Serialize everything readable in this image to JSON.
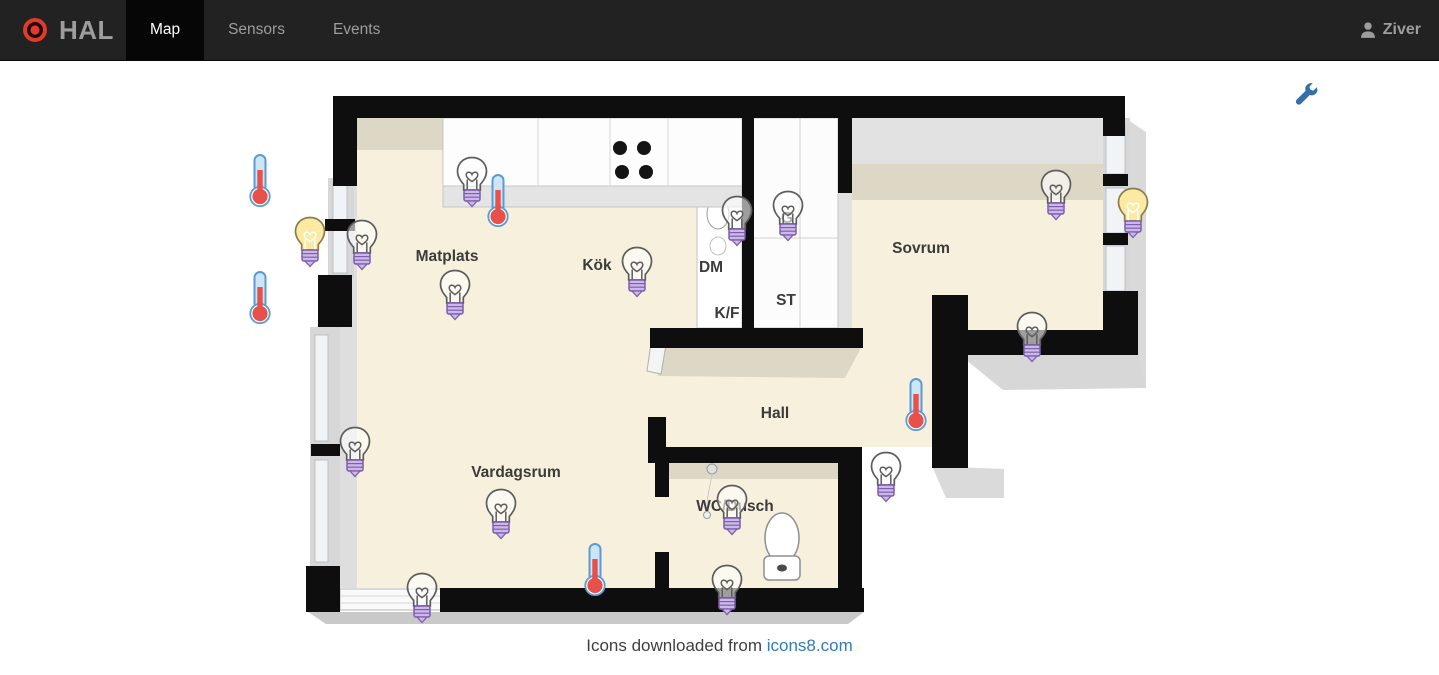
{
  "navbar": {
    "brand": "HAL",
    "tabs": [
      {
        "id": "map",
        "label": "Map",
        "active": true
      },
      {
        "id": "sensors",
        "label": "Sensors",
        "active": false
      },
      {
        "id": "events",
        "label": "Events",
        "active": false
      }
    ],
    "user": {
      "name": "Ziver"
    }
  },
  "toolbar": {
    "wrench": {
      "x": 1307,
      "y": 95
    }
  },
  "map": {
    "room_labels": [
      {
        "text": "Matplats",
        "x": 447,
        "y": 257
      },
      {
        "text": "Kök",
        "x": 597,
        "y": 266
      },
      {
        "text": "DM",
        "x": 711,
        "y": 268
      },
      {
        "text": "K/F",
        "x": 727,
        "y": 314
      },
      {
        "text": "ST",
        "x": 786,
        "y": 301
      },
      {
        "text": "G",
        "x": 787,
        "y": 219
      },
      {
        "text": "Sovrum",
        "x": 921,
        "y": 249
      },
      {
        "text": "Hall",
        "x": 775,
        "y": 414
      },
      {
        "text": "Vardagsrum",
        "x": 516,
        "y": 473
      },
      {
        "text": "WC/Dusch",
        "x": 735,
        "y": 507
      }
    ],
    "sensors": [
      {
        "type": "thermometer",
        "x": 260,
        "y": 180
      },
      {
        "type": "thermometer",
        "x": 260,
        "y": 297
      },
      {
        "type": "thermometer",
        "x": 498,
        "y": 200
      },
      {
        "type": "thermometer",
        "x": 916,
        "y": 404
      },
      {
        "type": "thermometer",
        "x": 595,
        "y": 569
      },
      {
        "type": "bulb-on",
        "x": 310,
        "y": 242
      },
      {
        "type": "bulb-on",
        "x": 1133,
        "y": 213
      },
      {
        "type": "bulb-off",
        "x": 472,
        "y": 182
      },
      {
        "type": "bulb-off",
        "x": 362,
        "y": 245
      },
      {
        "type": "bulb-off",
        "x": 455,
        "y": 295
      },
      {
        "type": "bulb-off",
        "x": 637,
        "y": 272
      },
      {
        "type": "bulb-off",
        "x": 737,
        "y": 221
      },
      {
        "type": "bulb-off",
        "x": 788,
        "y": 216
      },
      {
        "type": "bulb-off",
        "x": 1056,
        "y": 195
      },
      {
        "type": "bulb-off",
        "x": 1032,
        "y": 337
      },
      {
        "type": "bulb-off",
        "x": 886,
        "y": 477
      },
      {
        "type": "bulb-off",
        "x": 355,
        "y": 452
      },
      {
        "type": "bulb-off",
        "x": 501,
        "y": 514
      },
      {
        "type": "bulb-off",
        "x": 422,
        "y": 598
      },
      {
        "type": "bulb-off",
        "x": 732,
        "y": 510
      },
      {
        "type": "bulb-off",
        "x": 727,
        "y": 590
      }
    ]
  },
  "footer": {
    "prefix": "Icons downloaded from ",
    "link_text": "icons8.com"
  },
  "colors": {
    "navbar_bg": "#222222",
    "navbar_active_bg": "#060606",
    "navbar_text": "#9d9d9d",
    "logo_red": "#e23b2e",
    "link_blue": "#337ab7",
    "wrench_blue": "#356fa8",
    "bulb_on_yellow": "#fce9a2",
    "bulb_base_purple": "#cdb9e8",
    "thermometer_red": "#e8514a",
    "thermometer_blue": "#5b9bd5",
    "floor_cream": "#f7f0dc",
    "wall_black": "#0e0e0e"
  }
}
